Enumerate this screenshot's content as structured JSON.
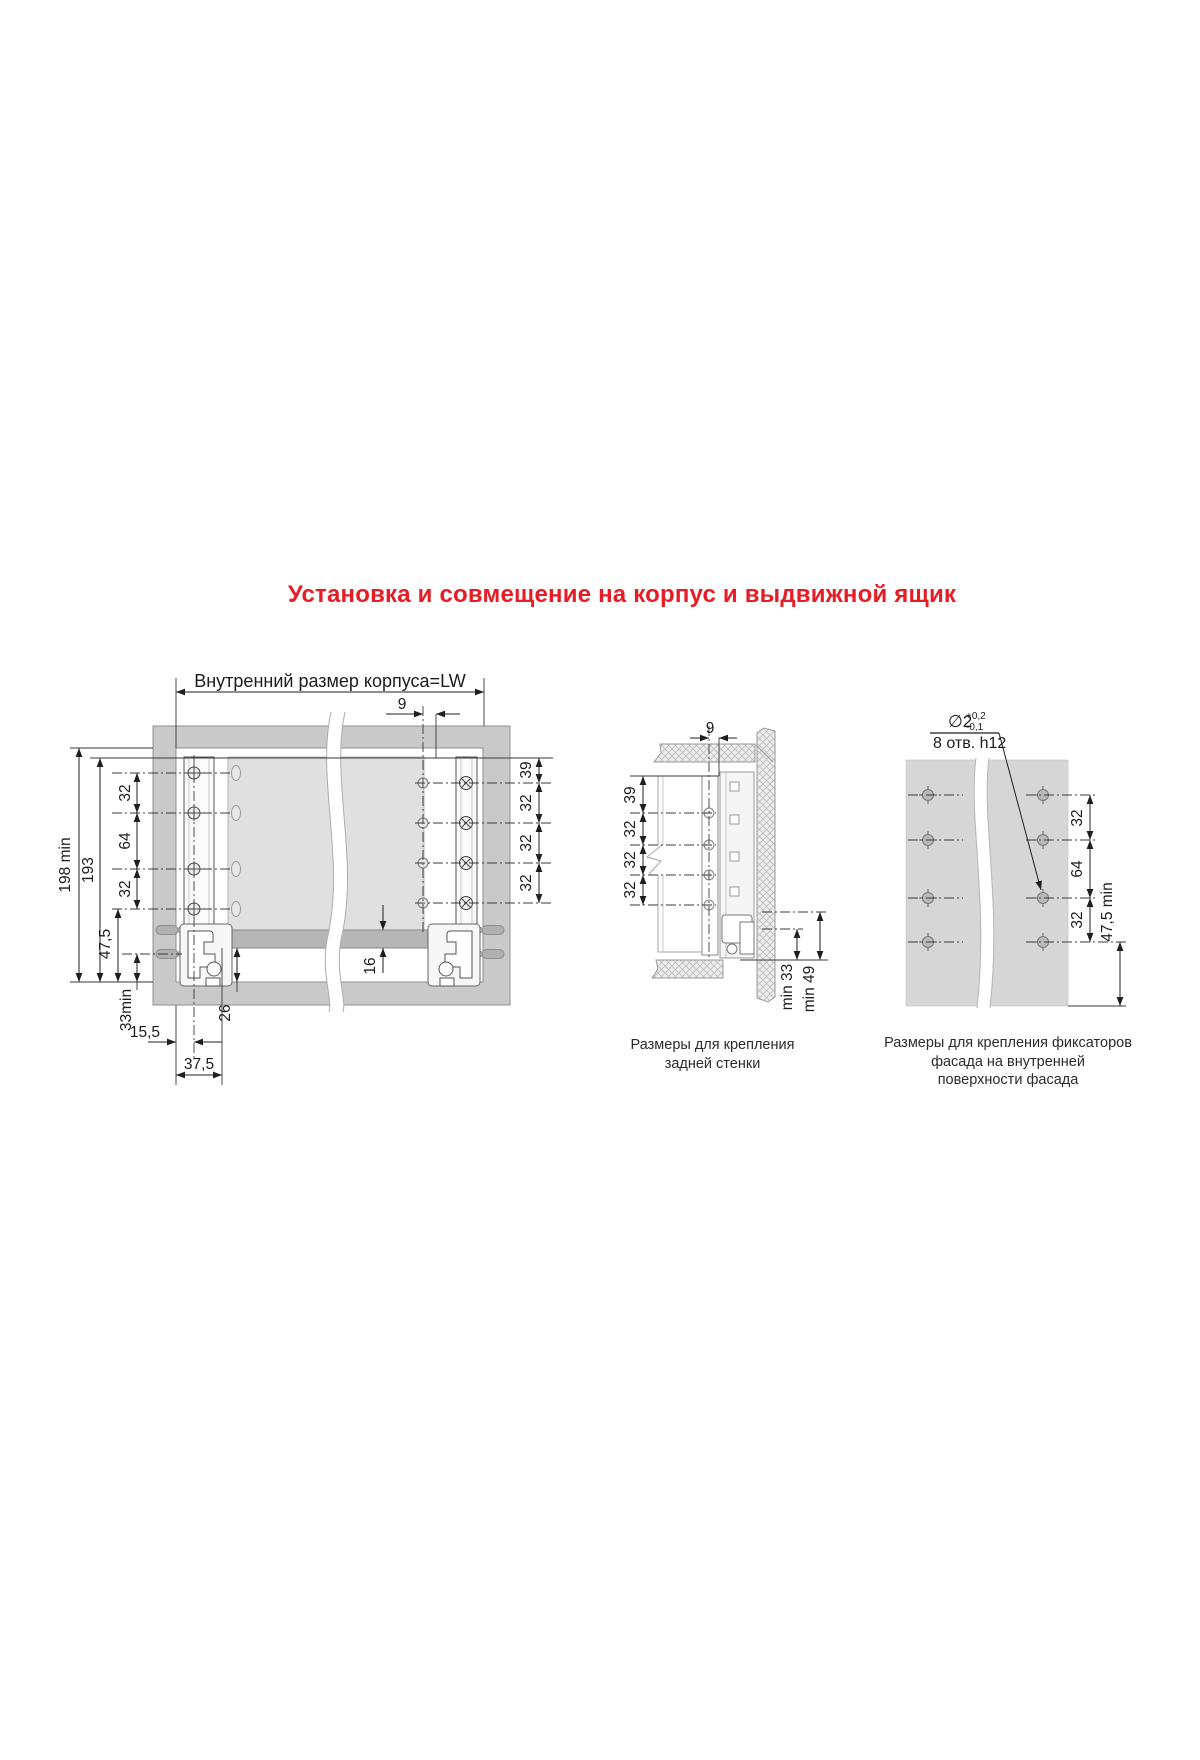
{
  "title": "Установка и совмещение на корпус и выдвижной ящик",
  "accent_color": "#e81c24",
  "left_diagram": {
    "header_dim": "Внутренний размер корпуса=LW",
    "offset_dim": "9",
    "height_total": "198 min",
    "height_inner": "193",
    "pitch_chain": [
      "32",
      "64",
      "32"
    ],
    "bottom_offset": "47,5",
    "min_clearance": "33min",
    "front_offset": "15,5",
    "slide_offset": "37,5",
    "bottom_gap": "26",
    "panel_thickness": "16",
    "right_chain": [
      "39",
      "32",
      "32",
      "32"
    ]
  },
  "middle_diagram": {
    "offset_dim": "9",
    "pitch_chain": [
      "39",
      "32",
      "32",
      "32"
    ],
    "min_back": "min 33",
    "min_front": "min 49",
    "caption": [
      "Размеры для крепления",
      "задней стенки"
    ]
  },
  "right_diagram": {
    "hole_dia": "∅2",
    "tol_plus": "+0,2",
    "tol_minus": "-0,1",
    "holes_note": "8 отв. h12",
    "pitch_chain": [
      "32",
      "64",
      "32"
    ],
    "edge_dim": "47,5 min",
    "caption": [
      "Размеры для крепления фиксаторов",
      "фасада на внутренней",
      "поверхности фасада"
    ]
  }
}
